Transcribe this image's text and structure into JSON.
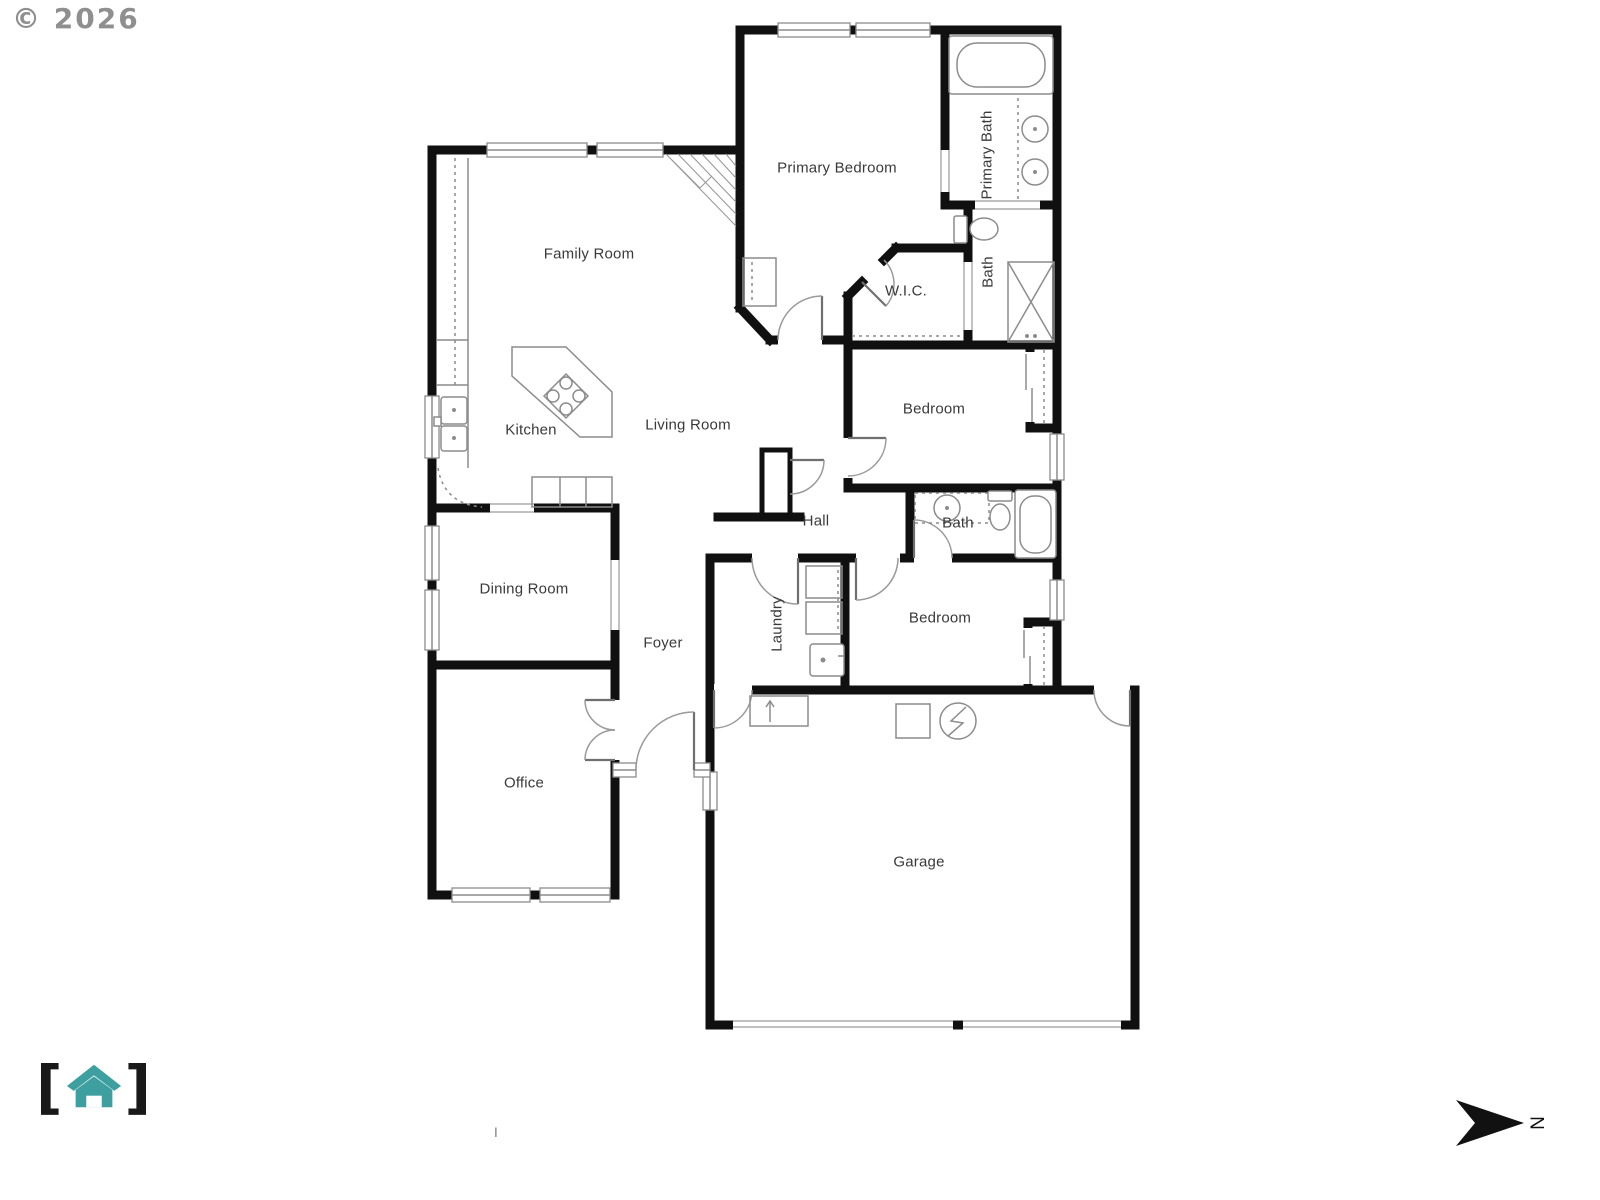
{
  "watermark": "© 2026",
  "rooms": {
    "family_room": "Family Room",
    "kitchen": "Kitchen",
    "living_room": "Living Room",
    "primary_bedroom": "Primary Bedroom",
    "primary_bath": "Primary Bath",
    "walk_in_closet": "W.I.C.",
    "primary_water_closet": "Bath",
    "bedroom_upper": "Bedroom",
    "hall": "Hall",
    "hall_bath": "Bath",
    "dining_room": "Dining Room",
    "foyer": "Foyer",
    "laundry": "Laundry",
    "bedroom_lower": "Bedroom",
    "office": "Office",
    "garage": "Garage"
  },
  "compass": {
    "north_label": "N"
  },
  "logo": {
    "bracket_left": "[",
    "bracket_right": "]"
  },
  "footer_mark": "I",
  "colors": {
    "wall": "#101010",
    "fixture_line": "#8c8c8c",
    "door_arc": "#9a9a9a",
    "label": "#3a3a3a",
    "watermark": "#8f8f8f",
    "logo_teal": "#3d9fa0",
    "logo_bracket": "#191919"
  }
}
